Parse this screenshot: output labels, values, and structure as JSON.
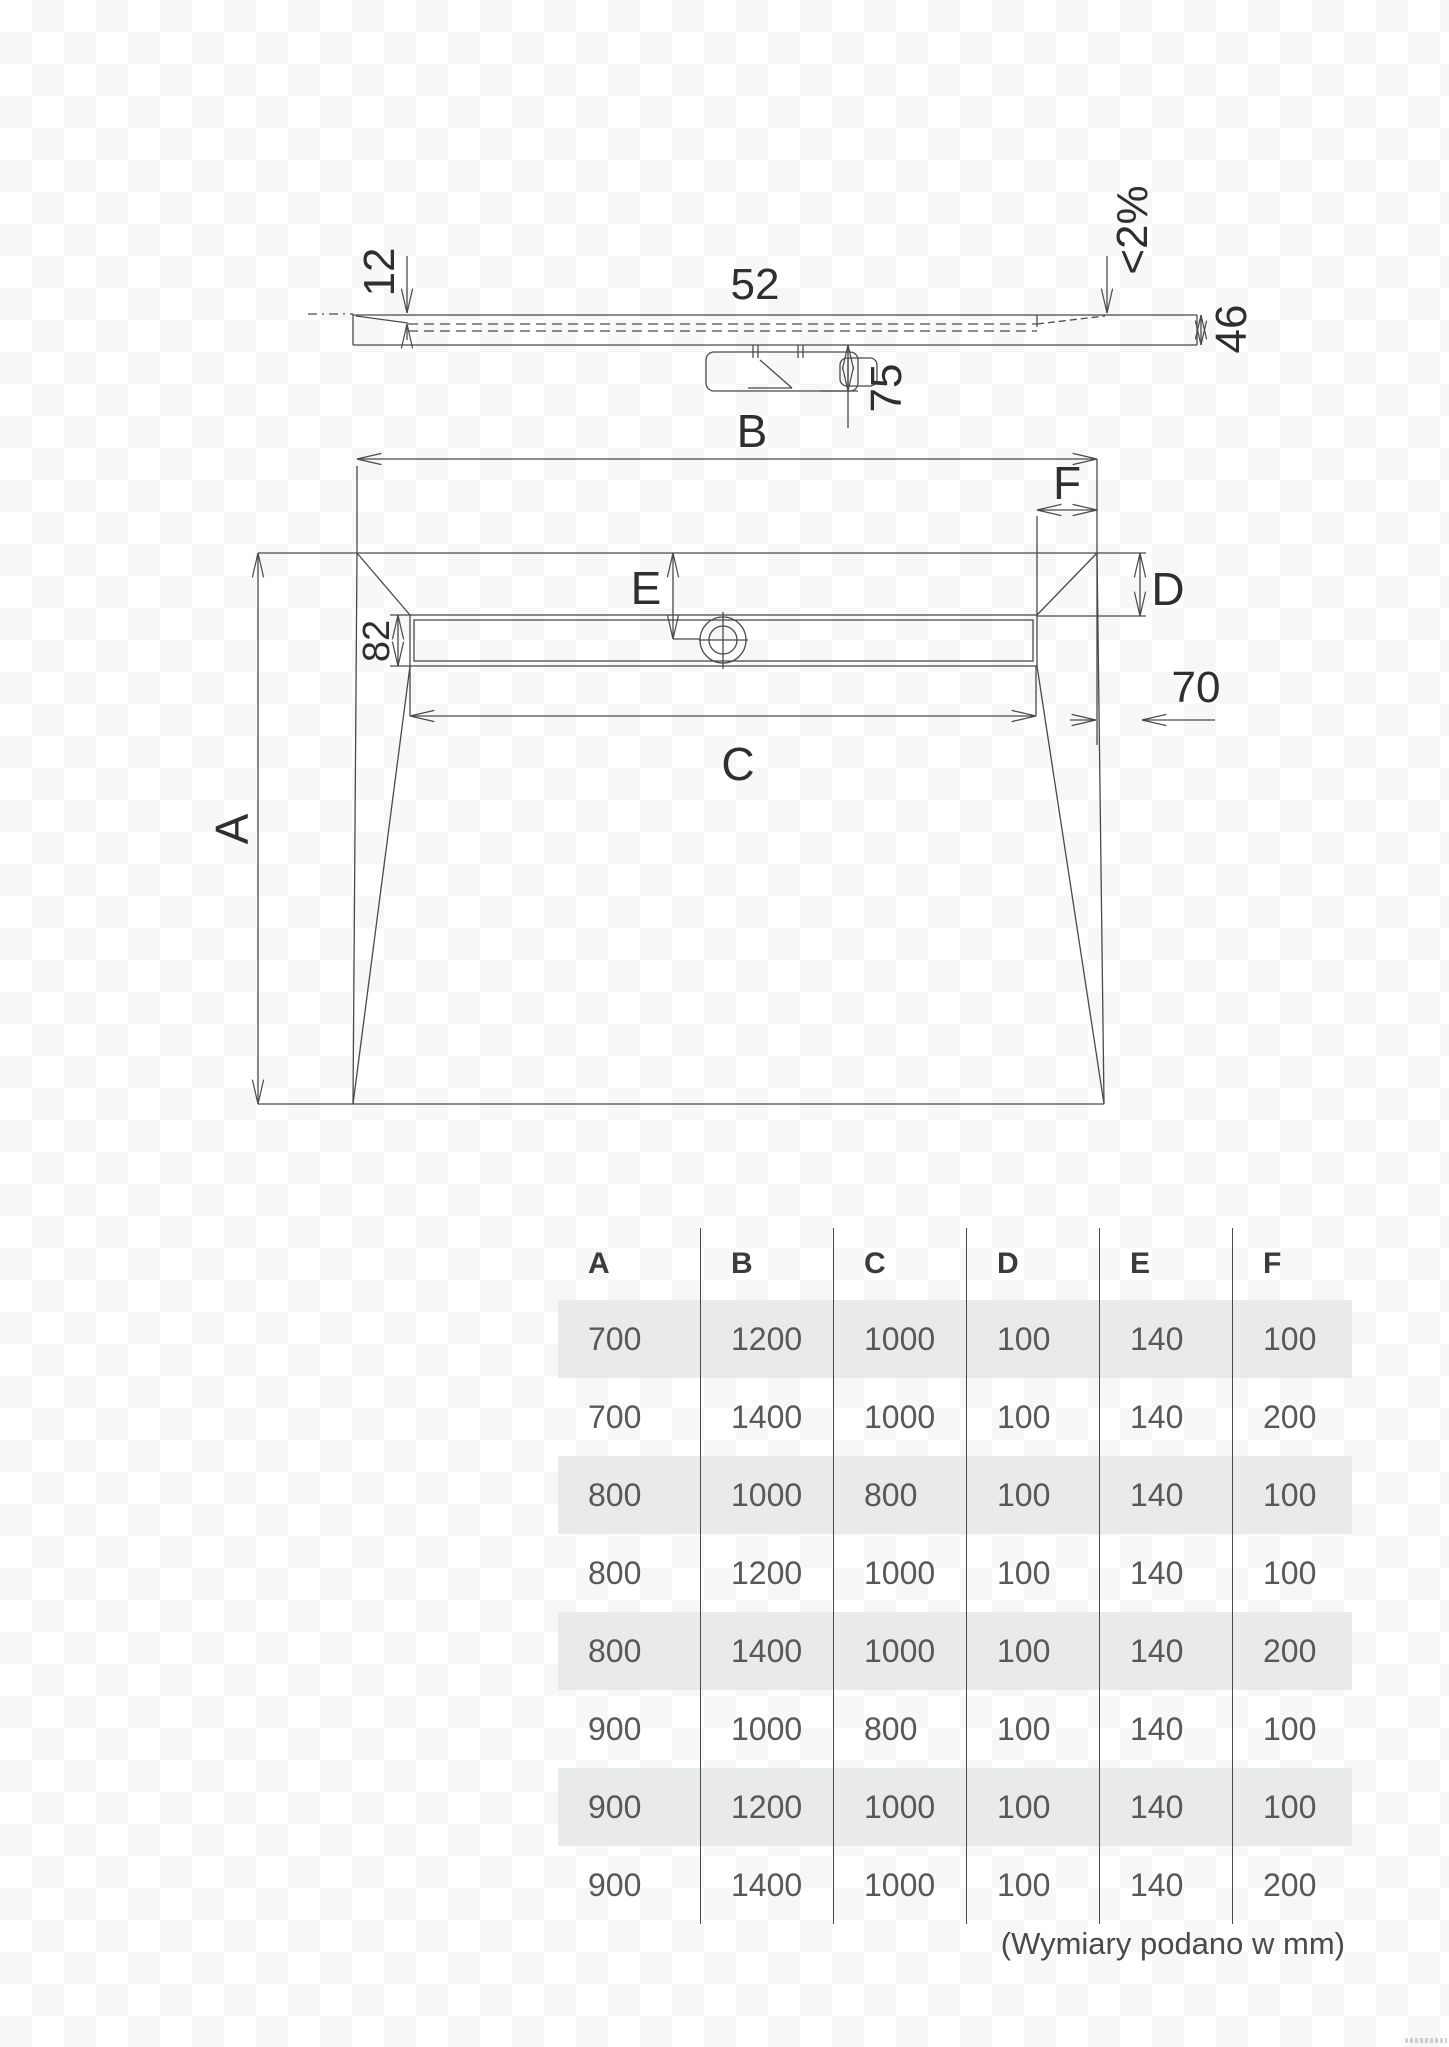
{
  "drawing": {
    "section_labels": {
      "recess_depth": "12",
      "outlet_width": "52",
      "slope": "<2%",
      "tray_height": "46",
      "trap_depth": "75"
    },
    "plan_labels": {
      "width": "B",
      "end_offset": "F",
      "drain_center": "E",
      "side_depth": "D",
      "channel_height": "82",
      "bottom_offset": "70",
      "channel_length": "C",
      "length": "A"
    }
  },
  "table": {
    "headers": [
      "A",
      "B",
      "C",
      "D",
      "E",
      "F"
    ],
    "rows": [
      [
        "700",
        "1200",
        "1000",
        "100",
        "140",
        "100"
      ],
      [
        "700",
        "1400",
        "1000",
        "100",
        "140",
        "200"
      ],
      [
        "800",
        "1000",
        "800",
        "100",
        "140",
        "100"
      ],
      [
        "800",
        "1200",
        "1000",
        "100",
        "140",
        "100"
      ],
      [
        "800",
        "1400",
        "1000",
        "100",
        "140",
        "200"
      ],
      [
        "900",
        "1000",
        "800",
        "100",
        "140",
        "100"
      ],
      [
        "900",
        "1200",
        "1000",
        "100",
        "140",
        "100"
      ],
      [
        "900",
        "1400",
        "1000",
        "100",
        "140",
        "200"
      ]
    ]
  },
  "footer": {
    "note": "(Wymiary podano w mm)"
  },
  "colors": {
    "line": "#4a4a4a",
    "label": "#2f2f2f",
    "row_shade": "#e9eaea",
    "background": "#ffffff",
    "checker": "#f6f7f7"
  }
}
